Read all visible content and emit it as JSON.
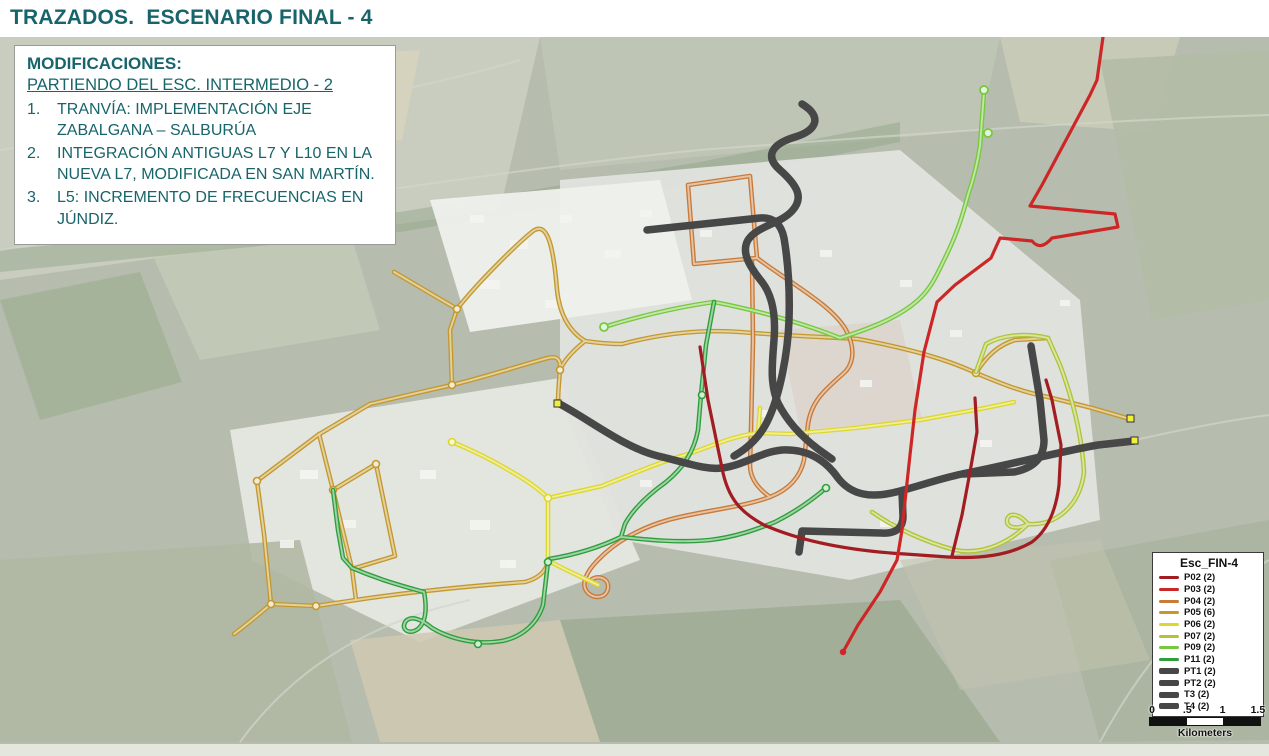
{
  "title": "TRAZADOS.  ESCENARIO FINAL - 4",
  "modifications": {
    "heading": "MODIFICACIONES:",
    "subheading": "PARTIENDO DEL ESC. INTERMEDIO - 2",
    "items": [
      {
        "num": "1.",
        "text": "TRANVÍA: IMPLEMENTACIÓN EJE ZABALGANA – SALBURÚA"
      },
      {
        "num": "2.",
        "text": "INTEGRACIÓN ANTIGUAS L7 Y L10 EN LA NUEVA L7, MODIFICADA EN SAN MARTÍN."
      },
      {
        "num": "3.",
        "text": "L5: INCREMENTO DE FRECUENCIAS EN JÚNDIZ."
      }
    ]
  },
  "legend": {
    "title": "Esc_FIN-4",
    "items": [
      {
        "id": "P02",
        "label": "P02 (2)",
        "color": "#a21d22",
        "thick": false
      },
      {
        "id": "P03",
        "label": "P03 (2)",
        "color": "#cc2726",
        "thick": false
      },
      {
        "id": "P04",
        "label": "P04 (2)",
        "color": "#c87a38",
        "thick": false
      },
      {
        "id": "P05",
        "label": "P05 (6)",
        "color": "#c3992e",
        "thick": false
      },
      {
        "id": "P06",
        "label": "P06 (2)",
        "color": "#ddd72c",
        "thick": false
      },
      {
        "id": "P07",
        "label": "P07 (2)",
        "color": "#afc437",
        "thick": false
      },
      {
        "id": "P09",
        "label": "P09 (2)",
        "color": "#77c83f",
        "thick": false
      },
      {
        "id": "P11",
        "label": "P11 (2)",
        "color": "#2e9e3c",
        "thick": false
      },
      {
        "id": "PT1",
        "label": "PT1 (2)",
        "color": "#474747",
        "thick": true
      },
      {
        "id": "PT2",
        "label": "PT2 (2)",
        "color": "#474747",
        "thick": true
      },
      {
        "id": "T3",
        "label": "T3 (2)",
        "color": "#474747",
        "thick": true
      },
      {
        "id": "T4",
        "label": "T4 (2)",
        "color": "#474747",
        "thick": true
      }
    ]
  },
  "scalebar": {
    "labels": [
      "0",
      ".5",
      "1",
      "1.5"
    ],
    "unit": "Kilometers"
  },
  "colors": {
    "accent_teal": "#17656b",
    "terminus_dot": "#f2ee3c",
    "map_base": "#b6bcae"
  }
}
